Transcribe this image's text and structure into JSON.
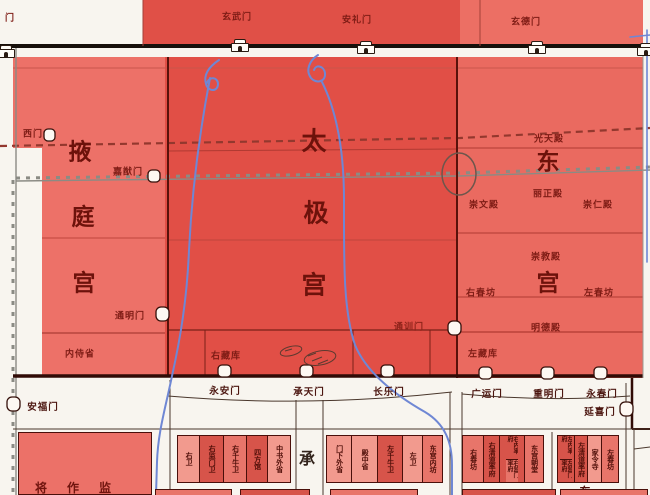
{
  "top_area": {
    "partial_left_gate": "门",
    "gate_xuanwu": "玄武门",
    "gate_anli": "安礼门",
    "gate_xuande": "玄德门"
  },
  "yeting_palace": {
    "name_chars": [
      "掖",
      "庭",
      "宫"
    ],
    "gate_ximen": "西门",
    "gate_jiayou": "嘉猷门",
    "gate_tongming": "通明门",
    "gate_anfu": "安福门",
    "office_neishisheng": "内侍省"
  },
  "taiji_palace": {
    "name_chars": [
      "太",
      "极",
      "宫"
    ],
    "store_youzangku": "右藏库",
    "gate_yongan": "永安门",
    "gate_chengtian": "承天门",
    "gate_changle": "长乐门",
    "gate_tongxun": "通训门"
  },
  "east_palace": {
    "name_chars": [
      "东",
      "宫"
    ],
    "hall_guangtian": "光天殿",
    "hall_lizheng": "丽正殿",
    "hall_chongwen": "崇文殿",
    "hall_chongren": "崇仁殿",
    "hall_chongjiao": "崇教殿",
    "hall_mingde": "明德殿",
    "office_youchunfang": "右春坊",
    "office_zuochunfang": "左春坊",
    "store_zuozangku": "左藏库",
    "gate_guangyun": "广运门",
    "gate_chongming": "重明门",
    "gate_yongchun": "永春门",
    "gate_yanxi": "延喜门"
  },
  "imperial_city": {
    "street_char": "承",
    "office_jiangzuojian": "将作监",
    "partial_char": "东",
    "office_groups": [
      {
        "boxes": [
          {
            "label": "右卫"
          },
          {
            "label": "右监门卫"
          },
          {
            "label": "右千牛卫"
          },
          {
            "label": "四方馆"
          },
          {
            "label": "中书外省"
          }
        ]
      },
      {
        "boxes": [
          {
            "label": "门下外省"
          },
          {
            "label": "殿中省"
          },
          {
            "label": "左千牛卫"
          },
          {
            "label": "左卫"
          },
          {
            "label": "东宫内坊"
          }
        ]
      },
      {
        "boxes": [
          {
            "label": "右春坊"
          },
          {
            "label": "右清道率府"
          },
          {
            "label": "右内率府",
            "label2": "右监门率府"
          },
          {
            "label": "东宫朝堂"
          }
        ]
      },
      {
        "boxes": [
          {
            "label": "左内率府",
            "label2": "左监门率府"
          },
          {
            "label": "左清道率府"
          },
          {
            "label": "家令寺"
          },
          {
            "label": "左春坊"
          }
        ]
      }
    ]
  },
  "colors": {
    "palace_red_dark": "#e14f46",
    "palace_red_mid": "#ea6a60",
    "palace_red_light": "#ed7168",
    "river_blue": "#6f87d4",
    "wall_dark": "#2e0a06",
    "label_maroon": "#7e1c15"
  }
}
